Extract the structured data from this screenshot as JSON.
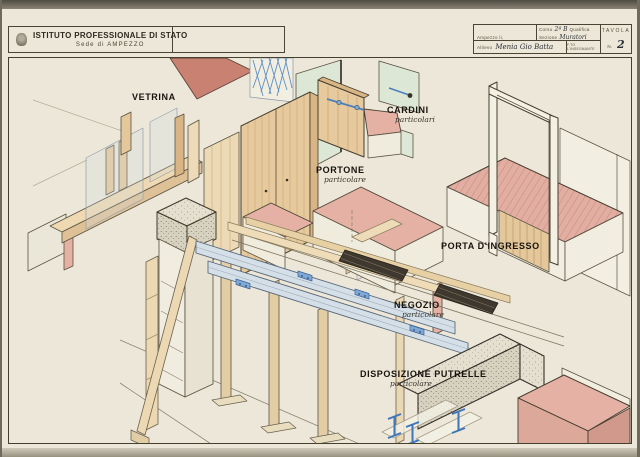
{
  "sheet": {
    "header": {
      "institute": "ISTITUTO PROFESSIONALE DI STATO",
      "location": "Sede di AMPEZZO"
    },
    "title_block": {
      "place_label": "Ampezzo li,",
      "date_value": "14 - II 1957",
      "course_label": "Corso",
      "course_value": "2ª B",
      "qualifica_label": "Qualifica",
      "sezione_label": "Sezione",
      "sezione_value": "Muratori",
      "signature_label": "F.TO L'INSEGNANTE",
      "student_label": "Allievo",
      "student_value": "Menia Gio Batta",
      "tavola_label": "TAVOLA",
      "number_label": "N.",
      "number_value": "2"
    },
    "drawing": {
      "labels": [
        {
          "text": "VETRINA",
          "subtitle": ""
        },
        {
          "text": "PORTONE",
          "subtitle": "particolare"
        },
        {
          "text": "CARDINI",
          "subtitle": "particolari"
        },
        {
          "text": "PORTA D'INGRESSO",
          "subtitle": ""
        },
        {
          "text": "NEGOZIO",
          "subtitle": "particolare"
        },
        {
          "text": "DISPOSIZIONE PUTRELLE",
          "subtitle": "particolare"
        }
      ],
      "colors": {
        "paper": "#ece7d8",
        "ink": "#45402e",
        "masonry_pink": "#e4b1a4",
        "wood": "#e4c89c",
        "wood_light": "#eedcb8",
        "panel_green": "#dde7d6",
        "steel_blue": "#3f76b8",
        "steel_light": "#d5dfe8",
        "concrete": "#d7d2c0",
        "roof_red": "#c98272"
      }
    }
  }
}
